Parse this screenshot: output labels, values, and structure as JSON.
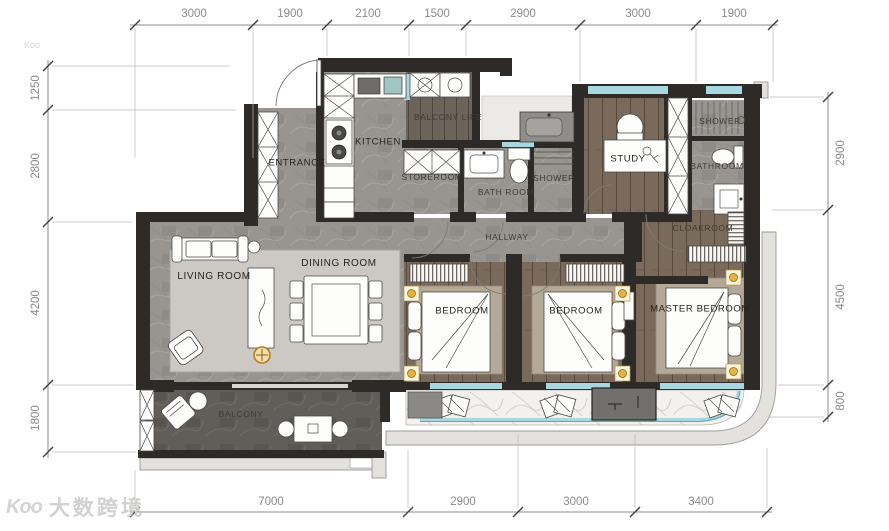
{
  "rooms": {
    "entrance": "ENTRANCE",
    "kitchen": "KITCHEN",
    "balcony_life": "BALCONY LIFE",
    "storeroom": "STOREROOM",
    "bath_room": "BATH ROOM",
    "shower_mid": "SHOWER",
    "study": "STUDY",
    "shower_top": "SHOWER",
    "bathroom": "BATHROOM",
    "hallway": "HALLWAY",
    "cloakroom": "CLOAKROOM",
    "living_room": "LIVING ROOM",
    "dining_room": "DINING ROOM",
    "bedroom_1": "BEDROOM",
    "bedroom_2": "BEDROOM",
    "master_bedroom": "MASTER BEDROOM",
    "balcony": "BALCONY"
  },
  "dimensions_mm": {
    "top": [
      "3000",
      "1900",
      "2100",
      "1500",
      "2900",
      "3000",
      "1900"
    ],
    "left": [
      "1250",
      "2800",
      "4200",
      "1800"
    ],
    "right": [
      "2900",
      "4500",
      "800"
    ],
    "bottom": [
      "7000",
      "2900",
      "3000",
      "3400"
    ]
  },
  "watermark": {
    "logo_text": "Koo",
    "text": "大数跨境",
    "mini": "Koo"
  },
  "colors": {
    "wall": "#2e2a27",
    "glass": "#a9d7e0",
    "gold": "#e2a93f",
    "wood": "#796a5b",
    "stone": "#98948f",
    "marble": "#f2f1ee"
  }
}
